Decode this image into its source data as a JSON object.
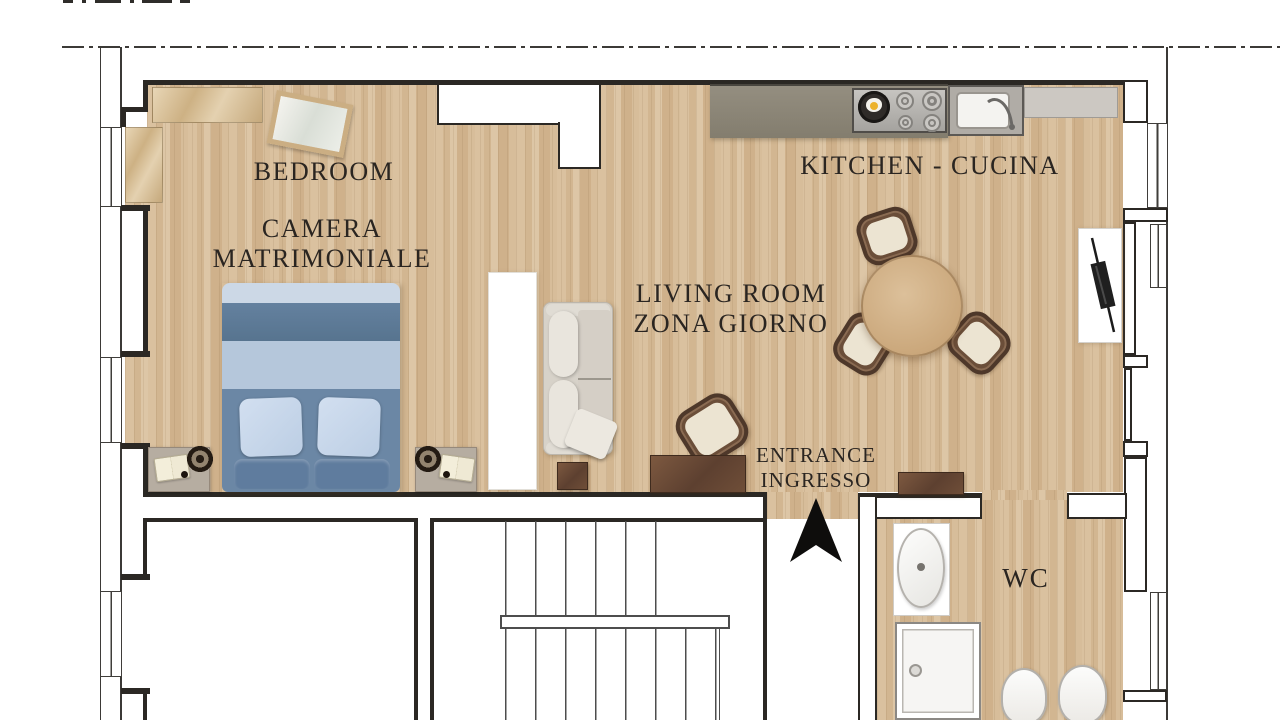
{
  "title": "Apartment floor plan",
  "rooms": {
    "bedroom": {
      "name_en": "BEDROOM",
      "name_it_line1": "CAMERA",
      "name_it_line2": "MATRIMONIALE"
    },
    "kitchen": {
      "label": "KITCHEN - CUCINA"
    },
    "living_room": {
      "name_en": "LIVING ROOM",
      "name_it": "ZONA GIORNO"
    },
    "entrance": {
      "name_en": "ENTRANCE",
      "name_it": "INGRESSO"
    },
    "wc": {
      "label": "WC"
    }
  },
  "colors": {
    "floor_wood": "#d6bc9a",
    "wall_dark": "#2b2824",
    "bed_blanket_dark": "#5d7a9a",
    "bed_blanket_light": "#b5c7db",
    "bed_base": "#6b87a5",
    "sofa_cream": "#d7d2c9",
    "counter_gray": "#8e887a",
    "counter_light": "#ccc8c2",
    "furniture_brown": "#6e4c38",
    "table_wood": "#cfae83",
    "label_text": "#2a2521"
  }
}
